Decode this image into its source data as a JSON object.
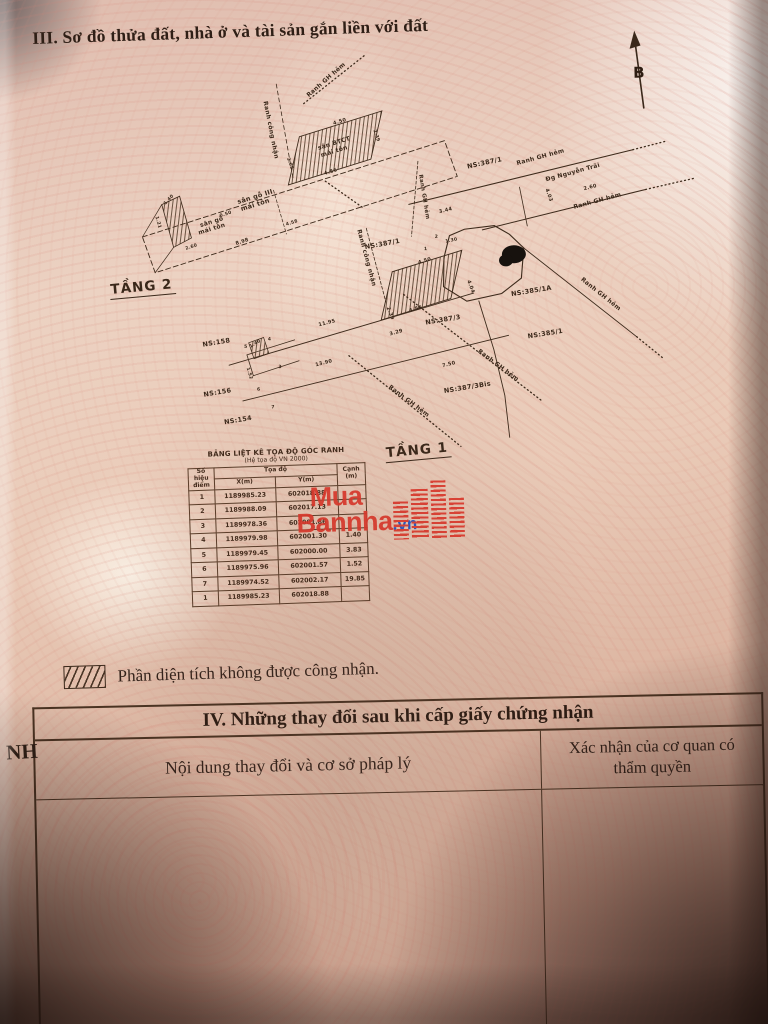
{
  "header": {
    "section_title": "III. Sơ đồ thửa đất, nhà ở và tài sản gắn liền với đất"
  },
  "compass": {
    "label": "B"
  },
  "floors": {
    "floor2_label": "TẦNG 2",
    "floor1_label": "TẦNG 1"
  },
  "map": {
    "labels": [
      {
        "t": "sân BTCT",
        "x": 342,
        "y": 144,
        "r": -16,
        "s": 6
      },
      {
        "t": "mái tôn",
        "x": 342,
        "y": 152,
        "r": -16,
        "s": 6
      },
      {
        "t": "sân gỗ III",
        "x": 262,
        "y": 196,
        "r": -16,
        "s": 6.5
      },
      {
        "t": "mái tôn",
        "x": 262,
        "y": 204,
        "r": -16,
        "s": 6.5
      },
      {
        "t": "sân gỗ",
        "x": 218,
        "y": 220,
        "r": -16,
        "s": 6
      },
      {
        "t": "mái tôn",
        "x": 218,
        "y": 227,
        "r": -16,
        "s": 6
      },
      {
        "t": "Ranh công nhận",
        "x": 277,
        "y": 128,
        "r": 80,
        "s": 6
      },
      {
        "t": "Ranh GH hẻm",
        "x": 336,
        "y": 80,
        "r": -40,
        "s": 6
      },
      {
        "t": "4.50",
        "x": 348,
        "y": 122,
        "r": -16,
        "s": 5
      },
      {
        "t": "4.56",
        "x": 338,
        "y": 172,
        "r": -16,
        "s": 5
      },
      {
        "t": "3.05",
        "x": 296,
        "y": 162,
        "r": 72,
        "s": 4.5
      },
      {
        "t": "2.39",
        "x": 383,
        "y": 136,
        "r": 72,
        "s": 4.5
      },
      {
        "t": "8.98",
        "x": 248,
        "y": 240,
        "r": -17,
        "s": 5
      },
      {
        "t": "4.58",
        "x": 298,
        "y": 222,
        "r": -17,
        "s": 4.5
      },
      {
        "t": "0.50",
        "x": 232,
        "y": 212,
        "r": -17,
        "s": 4.5
      },
      {
        "t": "2.60",
        "x": 197,
        "y": 244,
        "r": -17,
        "s": 4.5
      },
      {
        "t": "1.40",
        "x": 176,
        "y": 196,
        "r": -45,
        "s": 4.5
      },
      {
        "t": "1.21",
        "x": 163,
        "y": 218,
        "r": 75,
        "s": 4.5
      },
      {
        "t": "NS:387/1",
        "x": 492,
        "y": 167,
        "r": -11,
        "s": 6.5
      },
      {
        "t": "NS:387/1",
        "x": 388,
        "y": 246,
        "r": -9,
        "s": 6.5
      },
      {
        "t": "NS:385/1A",
        "x": 536,
        "y": 296,
        "r": -8,
        "s": 6.5
      },
      {
        "t": "NS:385/1",
        "x": 549,
        "y": 339,
        "r": -8,
        "s": 6.5
      },
      {
        "t": "NS:387/3",
        "x": 447,
        "y": 323,
        "r": -8,
        "s": 6.5
      },
      {
        "t": "NS:387/3Bis",
        "x": 470,
        "y": 391,
        "r": -8,
        "s": 6.5
      },
      {
        "t": "NS:158",
        "x": 220,
        "y": 341,
        "r": -8,
        "s": 6.5
      },
      {
        "t": "NS:156",
        "x": 220,
        "y": 391,
        "r": -8,
        "s": 6.5
      },
      {
        "t": "NS:154",
        "x": 240,
        "y": 419,
        "r": -8,
        "s": 6.5
      },
      {
        "t": "Đg Nguyễn Trãi",
        "x": 580,
        "y": 178,
        "r": -14,
        "s": 6
      },
      {
        "t": "Ranh GH hẻm",
        "x": 548,
        "y": 162,
        "r": -14,
        "s": 6
      },
      {
        "t": "Ranh GH hẻm",
        "x": 604,
        "y": 207,
        "r": -14,
        "s": 6
      },
      {
        "t": "Ranh GH hẻm",
        "x": 429,
        "y": 198,
        "r": 82,
        "s": 5.5
      },
      {
        "t": "Ranh GH hẻm",
        "x": 500,
        "y": 369,
        "r": 38,
        "s": 6
      },
      {
        "t": "Ranh GH hẻm",
        "x": 410,
        "y": 403,
        "r": 38,
        "s": 6
      },
      {
        "t": "Ranh GH hẻm",
        "x": 604,
        "y": 300,
        "r": 40,
        "s": 6
      },
      {
        "t": "Ranh công nhận",
        "x": 370,
        "y": 258,
        "r": 76,
        "s": 6
      },
      {
        "t": "11.95",
        "x": 331,
        "y": 323,
        "r": -13,
        "s": 5
      },
      {
        "t": "13.90",
        "x": 327,
        "y": 363,
        "r": -13,
        "s": 5
      },
      {
        "t": "3.44",
        "x": 452,
        "y": 213,
        "r": -13,
        "s": 5
      },
      {
        "t": "2.60",
        "x": 597,
        "y": 193,
        "r": -13,
        "s": 5
      },
      {
        "t": "4.03",
        "x": 554,
        "y": 199,
        "r": 72,
        "s": 5
      },
      {
        "t": "4.50",
        "x": 430,
        "y": 263,
        "r": -16,
        "s": 5
      },
      {
        "t": "4.56",
        "x": 420,
        "y": 311,
        "r": -16,
        "s": 5
      },
      {
        "t": "4.04",
        "x": 474,
        "y": 289,
        "r": 70,
        "s": 5
      },
      {
        "t": "3.29",
        "x": 400,
        "y": 334,
        "r": -14,
        "s": 5
      },
      {
        "t": "2.39",
        "x": 393,
        "y": 314,
        "r": 70,
        "s": 5
      },
      {
        "t": "7.50",
        "x": 452,
        "y": 367,
        "r": -13,
        "s": 5
      },
      {
        "t": "1.30",
        "x": 457,
        "y": 243,
        "r": -10,
        "s": 4.5
      },
      {
        "t": "2",
        "x": 442,
        "y": 239,
        "r": 0,
        "s": 4.5
      },
      {
        "t": "1",
        "x": 431,
        "y": 251,
        "r": 0,
        "s": 4.5
      },
      {
        "t": "1.40",
        "x": 259,
        "y": 342,
        "r": -30,
        "s": 4.5
      },
      {
        "t": "1.52",
        "x": 251,
        "y": 371,
        "r": 75,
        "s": 4.5
      },
      {
        "t": "3",
        "x": 283,
        "y": 366,
        "r": 0,
        "s": 4.5
      },
      {
        "t": "4",
        "x": 273,
        "y": 338,
        "r": 0,
        "s": 4.5
      },
      {
        "t": "5",
        "x": 249,
        "y": 345,
        "r": 0,
        "s": 4.5
      },
      {
        "t": "6",
        "x": 261,
        "y": 388,
        "r": 0,
        "s": 4.5
      },
      {
        "t": "7",
        "x": 275,
        "y": 406,
        "r": 0,
        "s": 4.5
      }
    ]
  },
  "coord_table": {
    "title": "BẢNG LIỆT KÊ TỌA ĐỘ GÓC RANH",
    "subtitle": "(Hệ tọa độ VN 2000)",
    "col_point": "Số hiệu điểm",
    "col_coord": "Tọa độ",
    "col_x": "X(m)",
    "col_y": "Y(m)",
    "col_edge": "Cạnh (m)",
    "rows": [
      {
        "p": "1",
        "x": "1189985.23",
        "y": "602018.88",
        "c": ""
      },
      {
        "p": "2",
        "x": "1189988.09",
        "y": "602017.13",
        "c": ""
      },
      {
        "p": "3",
        "x": "1189978.36",
        "y": "602001.86",
        "c": ""
      },
      {
        "p": "4",
        "x": "1189979.98",
        "y": "602001.30",
        "c": "1.40"
      },
      {
        "p": "5",
        "x": "1189979.45",
        "y": "602000.00",
        "c": "3.83"
      },
      {
        "p": "6",
        "x": "1189975.96",
        "y": "602001.57",
        "c": "1.52"
      },
      {
        "p": "7",
        "x": "1189974.52",
        "y": "602002.17",
        "c": "19.85"
      },
      {
        "p": "1",
        "x": "1189985.23",
        "y": "602018.88",
        "c": ""
      }
    ]
  },
  "watermark": {
    "word1": "Mua",
    "word2": "Bannha",
    "tld": ".vn",
    "red": "#df382c",
    "blue": "#1d55c8"
  },
  "legend": {
    "text": "Phần diện tích không được công nhận."
  },
  "section4": {
    "title": "IV. Những thay đổi sau khi cấp giấy chứng nhận",
    "col_left": "Nội dung thay đổi và cơ sở pháp lý",
    "col_right": "Xác nhận của cơ quan có thẩm quyền"
  },
  "margin_fragment": "NH",
  "colors": {
    "ink": "#33221a",
    "map_ink": "#3a281a",
    "paper": "#eacbb8"
  }
}
